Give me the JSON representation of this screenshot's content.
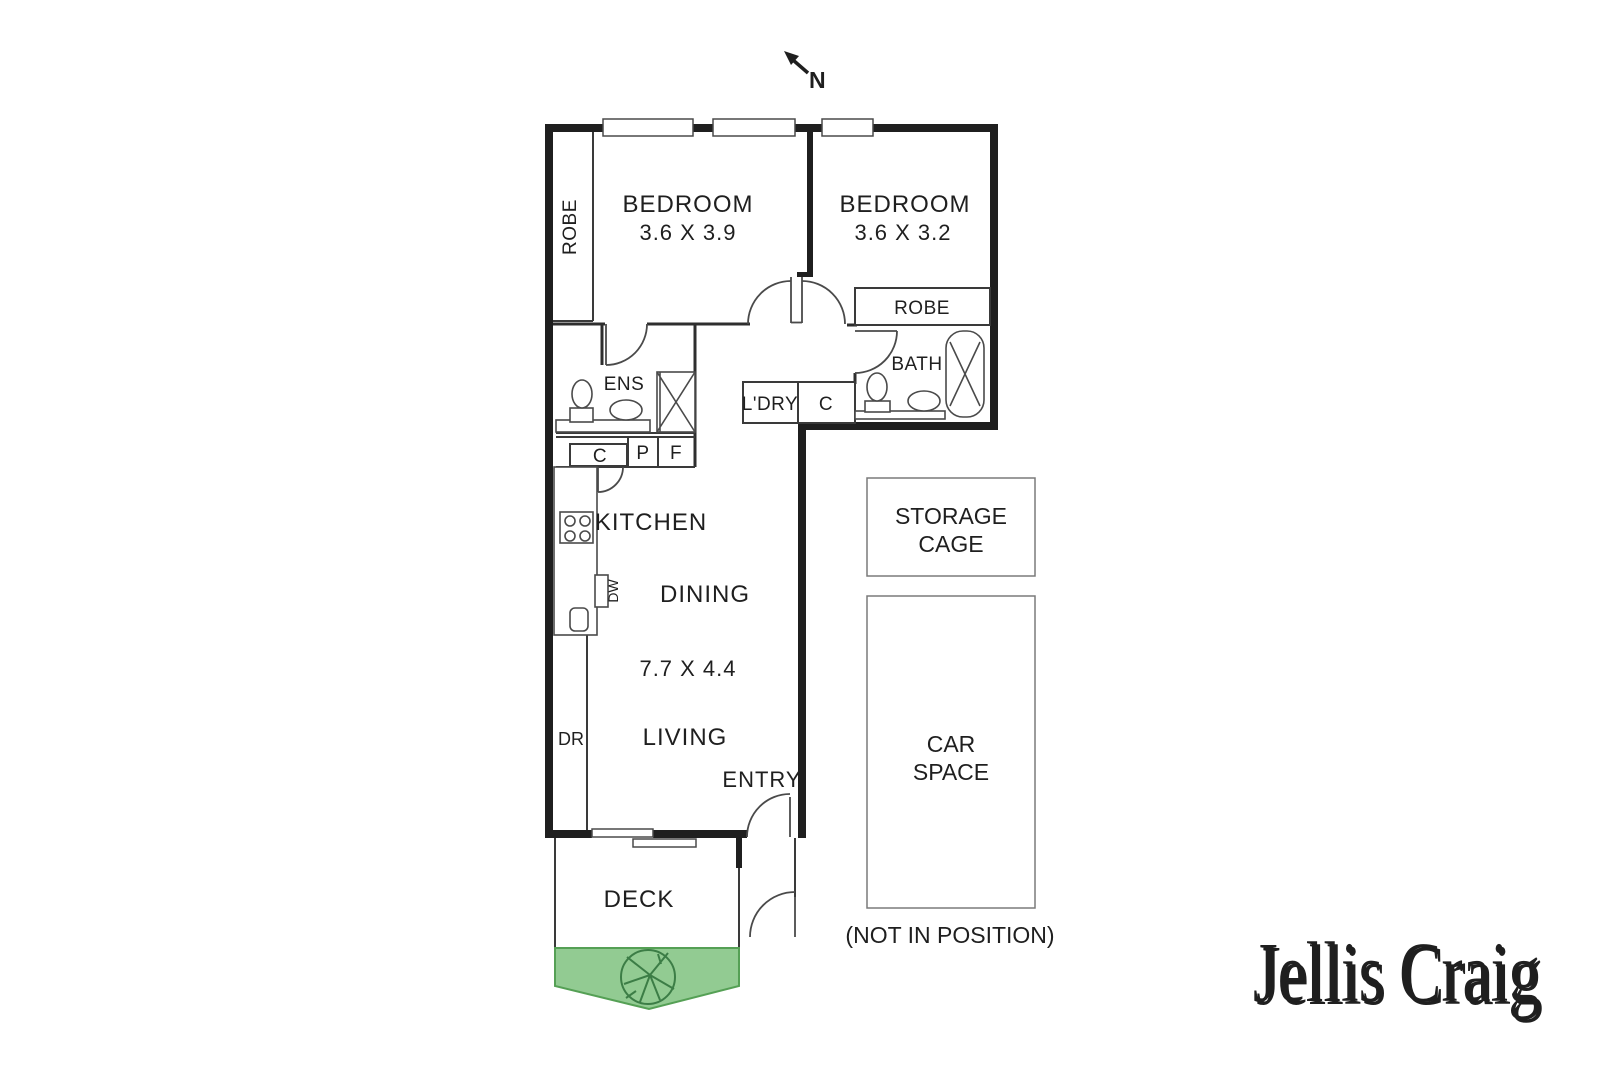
{
  "compass": {
    "label": "N"
  },
  "rooms": {
    "bedroom1": {
      "name": "BEDROOM",
      "dims": "3.6 X 3.9"
    },
    "bedroom2": {
      "name": "BEDROOM",
      "dims": "3.6 X 3.2"
    },
    "robe1": {
      "label": "ROBE"
    },
    "robe2": {
      "label": "ROBE"
    },
    "ensuite": {
      "label": "ENS"
    },
    "bath": {
      "label": "BATH"
    },
    "laundry": {
      "label": "L'DRY"
    },
    "hall_cupboard": {
      "label": "C"
    },
    "kitchen": {
      "label": "KITCHEN",
      "cupboard": "C",
      "pantry": "P",
      "fridge": "F",
      "dishwasher": "DW",
      "dryer": "DR"
    },
    "dining": {
      "label": "DINING"
    },
    "living": {
      "label": "LIVING",
      "dims": "7.7 X 4.4"
    },
    "entry": {
      "label": "ENTRY"
    },
    "deck": {
      "label": "DECK"
    }
  },
  "parking": {
    "storage_cage": {
      "line1": "STORAGE",
      "line2": "CAGE"
    },
    "car_space": {
      "line1": "CAR",
      "line2": "SPACE",
      "note": "(NOT IN POSITION)"
    }
  },
  "colors": {
    "wall": "#1f1f1f",
    "garden_fill": "#92cb92",
    "garden_stroke": "#55a055",
    "tree": "#3c7d46",
    "watermark": "#c4c4c4"
  },
  "branding": {
    "watermark": "Jellis Craig"
  }
}
